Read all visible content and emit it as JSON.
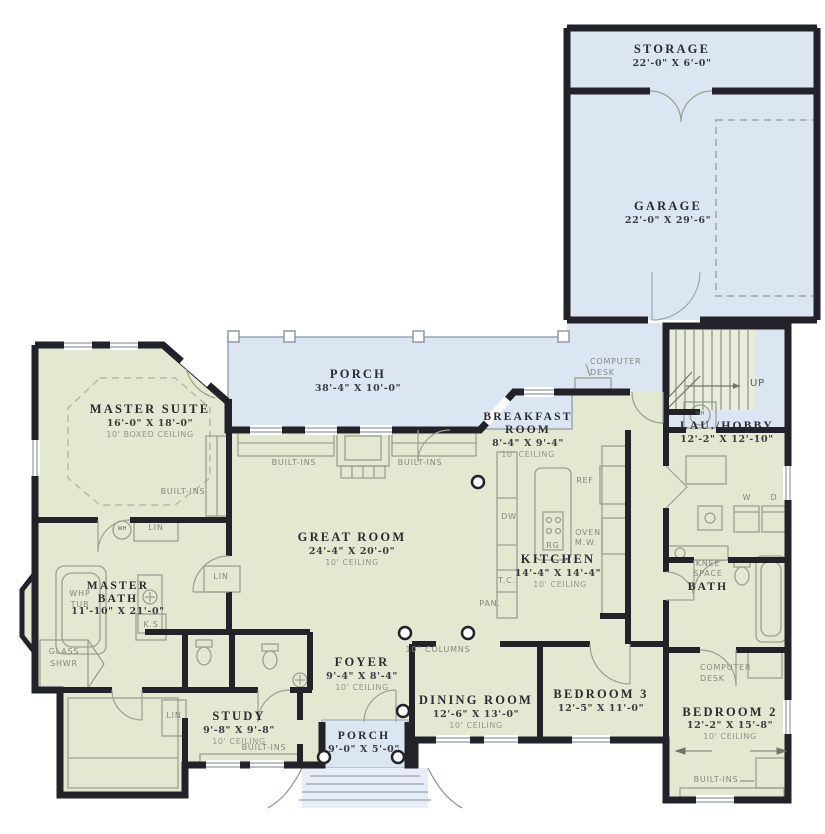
{
  "rooms": {
    "storage": {
      "name": "STORAGE",
      "dims": "22'-0\" X 6'-0\""
    },
    "garage": {
      "name": "GARAGE",
      "dims": "22'-0\" X 29'-6\""
    },
    "rear_porch": {
      "name": "PORCH",
      "dims": "38'-4\" X 10'-0\""
    },
    "master_suite": {
      "name": "MASTER SUITE",
      "dims": "16'-0\" X 18'-0\"",
      "ceiling": "10' BOXED CEILING"
    },
    "breakfast": {
      "line1": "BREAKFAST",
      "line2": "ROOM",
      "dims": "8'-4\" X 9'-4\"",
      "ceiling": "10' CEILING"
    },
    "lau_hobby": {
      "name": "LAU./HOBBY",
      "dims": "12'-2\" X 12'-10\""
    },
    "great_room": {
      "name": "GREAT ROOM",
      "dims": "24'-4\" X 20'-0\"",
      "ceiling": "10' CEILING"
    },
    "kitchen": {
      "name": "KITCHEN",
      "dims": "14'-4\" X 14'-4\"",
      "ceiling": "10' CEILING"
    },
    "master_bath": {
      "line1": "MASTER",
      "line2": "BATH",
      "dims": "11'-10\" X 21'-0\""
    },
    "bath": {
      "name": "BATH"
    },
    "foyer": {
      "name": "FOYER",
      "dims": "9'-4\" X 8'-4\"",
      "ceiling": "10' CEILING"
    },
    "dining": {
      "name": "DINING ROOM",
      "dims": "12'-6\" X 13'-0\"",
      "ceiling": "10' CEILING"
    },
    "bedroom3": {
      "name": "BEDROOM 3",
      "dims": "12'-5\" X 11'-0\""
    },
    "bedroom2": {
      "name": "BEDROOM 2",
      "dims": "12'-2\" X 15'-8\"",
      "ceiling": "10' CEILING"
    },
    "study": {
      "name": "STUDY",
      "dims": "9'-8\" X 9'-8\"",
      "ceiling": "10' CEILING"
    },
    "front_porch": {
      "name": "PORCH",
      "dims": "9'-0\" X 5'-0\""
    }
  },
  "labels": {
    "built_ins": "BUILT-INS",
    "lin": "LIN",
    "computer": "COMPUTER",
    "desk": "DESK",
    "up": "UP",
    "washer": "W",
    "dryer": "D",
    "wh": "WH",
    "ref": "REF",
    "oven": "OVEN",
    "mw": "M.W.",
    "rg": "RG",
    "dw": "DW",
    "tc": "T.C.",
    "pan": "PAN.",
    "ks": "K.S",
    "whp": "WHP",
    "tub": "TUB",
    "glass": "GLASS",
    "shwr": "SHWR",
    "knee": "KNEE",
    "space": "SPACE",
    "columns": "10\" COLUMNS"
  },
  "colors": {
    "floor_green": "#e3e9d1",
    "porch_blue": "#dce6f2",
    "wall_black": "#22222a"
  }
}
